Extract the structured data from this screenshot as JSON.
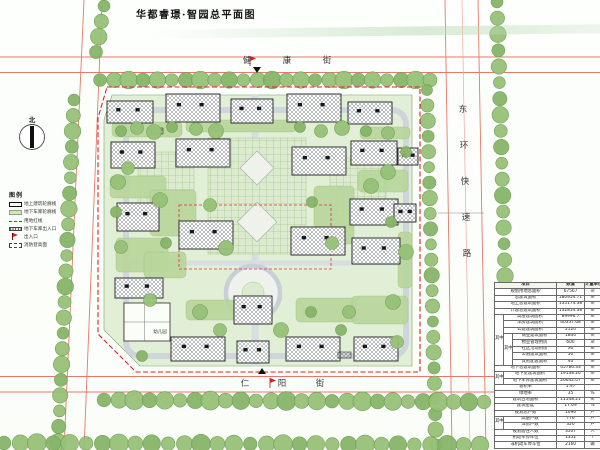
{
  "title": "华都睿璟·智园总平面图",
  "north_label": "北",
  "streets": {
    "top": "健康街",
    "right": "东环快速路",
    "bottom": "仁阳街"
  },
  "legend": {
    "title": "图例",
    "items": [
      {
        "label": "地上建筑轮廓线",
        "sym": "s-building"
      },
      {
        "label": "地下车库轮廓线",
        "sym": "s-garage"
      },
      {
        "label": "用地红线",
        "sym": "s-redline"
      },
      {
        "label": "地下车库出入口",
        "sym": "s-ramp"
      },
      {
        "label": "出入口",
        "sym": "s-flag"
      },
      {
        "label": "消防登高面",
        "sym": "s-fire"
      }
    ]
  },
  "colors": {
    "boundary_red": "#e02020",
    "road_line": "#e87868",
    "garage_green": "#e2efd7",
    "lawn_green": "#b9d79c",
    "tree_green": "#8fbd70"
  },
  "site": {
    "labels": [
      {
        "t": "幼儿园",
        "x": 160,
        "y": 333
      }
    ],
    "buildings": [
      [
        107,
        101,
        46,
        22
      ],
      [
        166,
        94,
        54,
        28
      ],
      [
        231,
        99,
        42,
        24
      ],
      [
        287,
        94,
        54,
        28
      ],
      [
        348,
        102,
        44,
        22
      ],
      [
        111,
        142,
        44,
        26
      ],
      [
        176,
        139,
        54,
        28
      ],
      [
        292,
        147,
        54,
        28
      ],
      [
        351,
        141,
        46,
        24
      ],
      [
        398,
        148,
        20,
        17
      ],
      [
        117,
        203,
        42,
        28
      ],
      [
        179,
        221,
        54,
        28
      ],
      [
        291,
        227,
        54,
        28
      ],
      [
        350,
        199,
        48,
        26
      ],
      [
        394,
        204,
        22,
        18
      ],
      [
        352,
        238,
        48,
        26
      ],
      [
        115,
        278,
        48,
        20
      ],
      [
        124,
        303,
        46,
        38,
        "o"
      ],
      [
        234,
        296,
        38,
        28
      ],
      [
        171,
        337,
        54,
        24
      ],
      [
        237,
        341,
        32,
        22
      ],
      [
        286,
        337,
        54,
        24
      ],
      [
        354,
        337,
        44,
        24
      ]
    ]
  },
  "table": {
    "rows": [
      [
        {
          "t": "项目",
          "cs": 3
        },
        {
          "t": "数值"
        },
        {
          "t": "计量单位"
        }
      ],
      [
        {
          "t": "规划用地总面积",
          "cs": 3
        },
        {
          "t": "67567"
        },
        {
          "t": "㎡"
        }
      ],
      [
        {
          "t": "总建筑面积",
          "cs": 3
        },
        {
          "t": "180954.71"
        },
        {
          "t": "㎡"
        }
      ],
      [
        {
          "t": "地上总建筑面积",
          "cs": 3
        },
        {
          "t": "135174.38"
        },
        {
          "t": "㎡"
        }
      ],
      [
        {
          "t": "计容总建筑面积",
          "cs": 3
        },
        {
          "t": "132854.38"
        },
        {
          "t": "㎡"
        }
      ],
      [
        {
          "t": "其中",
          "rs": 8
        },
        {
          "t": "高层建筑面积",
          "cs": 2
        },
        {
          "t": "89996.7"
        },
        {
          "t": "㎡"
        }
      ],
      [
        {
          "t": "洋房建筑面积",
          "cs": 2
        },
        {
          "t": "40337.68"
        },
        {
          "t": "㎡"
        }
      ],
      [
        {
          "t": "公建建筑面积",
          "cs": 2
        },
        {
          "t": "2520"
        },
        {
          "t": "㎡"
        }
      ],
      [
        {
          "t": "其中",
          "rs": 5
        },
        {
          "t": "商业建筑面积"
        },
        {
          "t": "1800"
        },
        {
          "t": "㎡"
        }
      ],
      [
        {
          "t": "物业管理用房"
        },
        {
          "t": "600"
        },
        {
          "t": "㎡"
        }
      ],
      [
        {
          "t": "社区活动用房"
        },
        {
          "t": "30"
        },
        {
          "t": "㎡"
        }
      ],
      [
        {
          "t": "公厕建筑面积"
        },
        {
          "t": "50"
        },
        {
          "t": "㎡"
        }
      ],
      [
        {
          "t": "其他配套面积"
        },
        {
          "t": "40"
        },
        {
          "t": "㎡"
        }
      ],
      [
        {
          "t": "地下总建筑面积",
          "cs": 3
        },
        {
          "t": "45780.33"
        },
        {
          "t": "㎡"
        }
      ],
      [
        {
          "t": "其中",
          "rs": 2
        },
        {
          "t": "地下室建筑面积",
          "cs": 2
        },
        {
          "t": "19138.26"
        },
        {
          "t": "㎡"
        }
      ],
      [
        {
          "t": "地下车库建筑面积",
          "cs": 2
        },
        {
          "t": "26642.07"
        },
        {
          "t": "㎡"
        }
      ],
      [
        {
          "t": "容积率",
          "cs": 3
        },
        {
          "t": "1.97"
        },
        {
          "t": ""
        }
      ],
      [
        {
          "t": "绿地率",
          "cs": 3
        },
        {
          "t": "35"
        },
        {
          "t": "%"
        }
      ],
      [
        {
          "t": "建筑占地面积",
          "cs": 3
        },
        {
          "t": "11548.21"
        },
        {
          "t": "㎡"
        }
      ],
      [
        {
          "t": "建筑密度",
          "cs": 3
        },
        {
          "t": "17.09"
        },
        {
          "t": "%"
        }
      ],
      [
        {
          "t": "规划总户数",
          "cs": 3
        },
        {
          "t": "1096"
        },
        {
          "t": "户"
        }
      ],
      [
        {
          "t": "其中",
          "rs": 2
        },
        {
          "t": "高层户数",
          "cs": 2
        },
        {
          "t": "776"
        },
        {
          "t": "户"
        }
      ],
      [
        {
          "t": "洋房户数",
          "cs": 2
        },
        {
          "t": "320"
        },
        {
          "t": "户"
        }
      ],
      [
        {
          "t": "规划居住人数",
          "cs": 3
        },
        {
          "t": "3507"
        },
        {
          "t": "人"
        }
      ],
      [
        {
          "t": "机动车停车位",
          "cs": 3
        },
        {
          "t": "1352"
        },
        {
          "t": "个"
        }
      ],
      [
        {
          "t": "非机动车停车位",
          "cs": 3
        },
        {
          "t": "2160"
        },
        {
          "t": "辆"
        }
      ]
    ]
  }
}
